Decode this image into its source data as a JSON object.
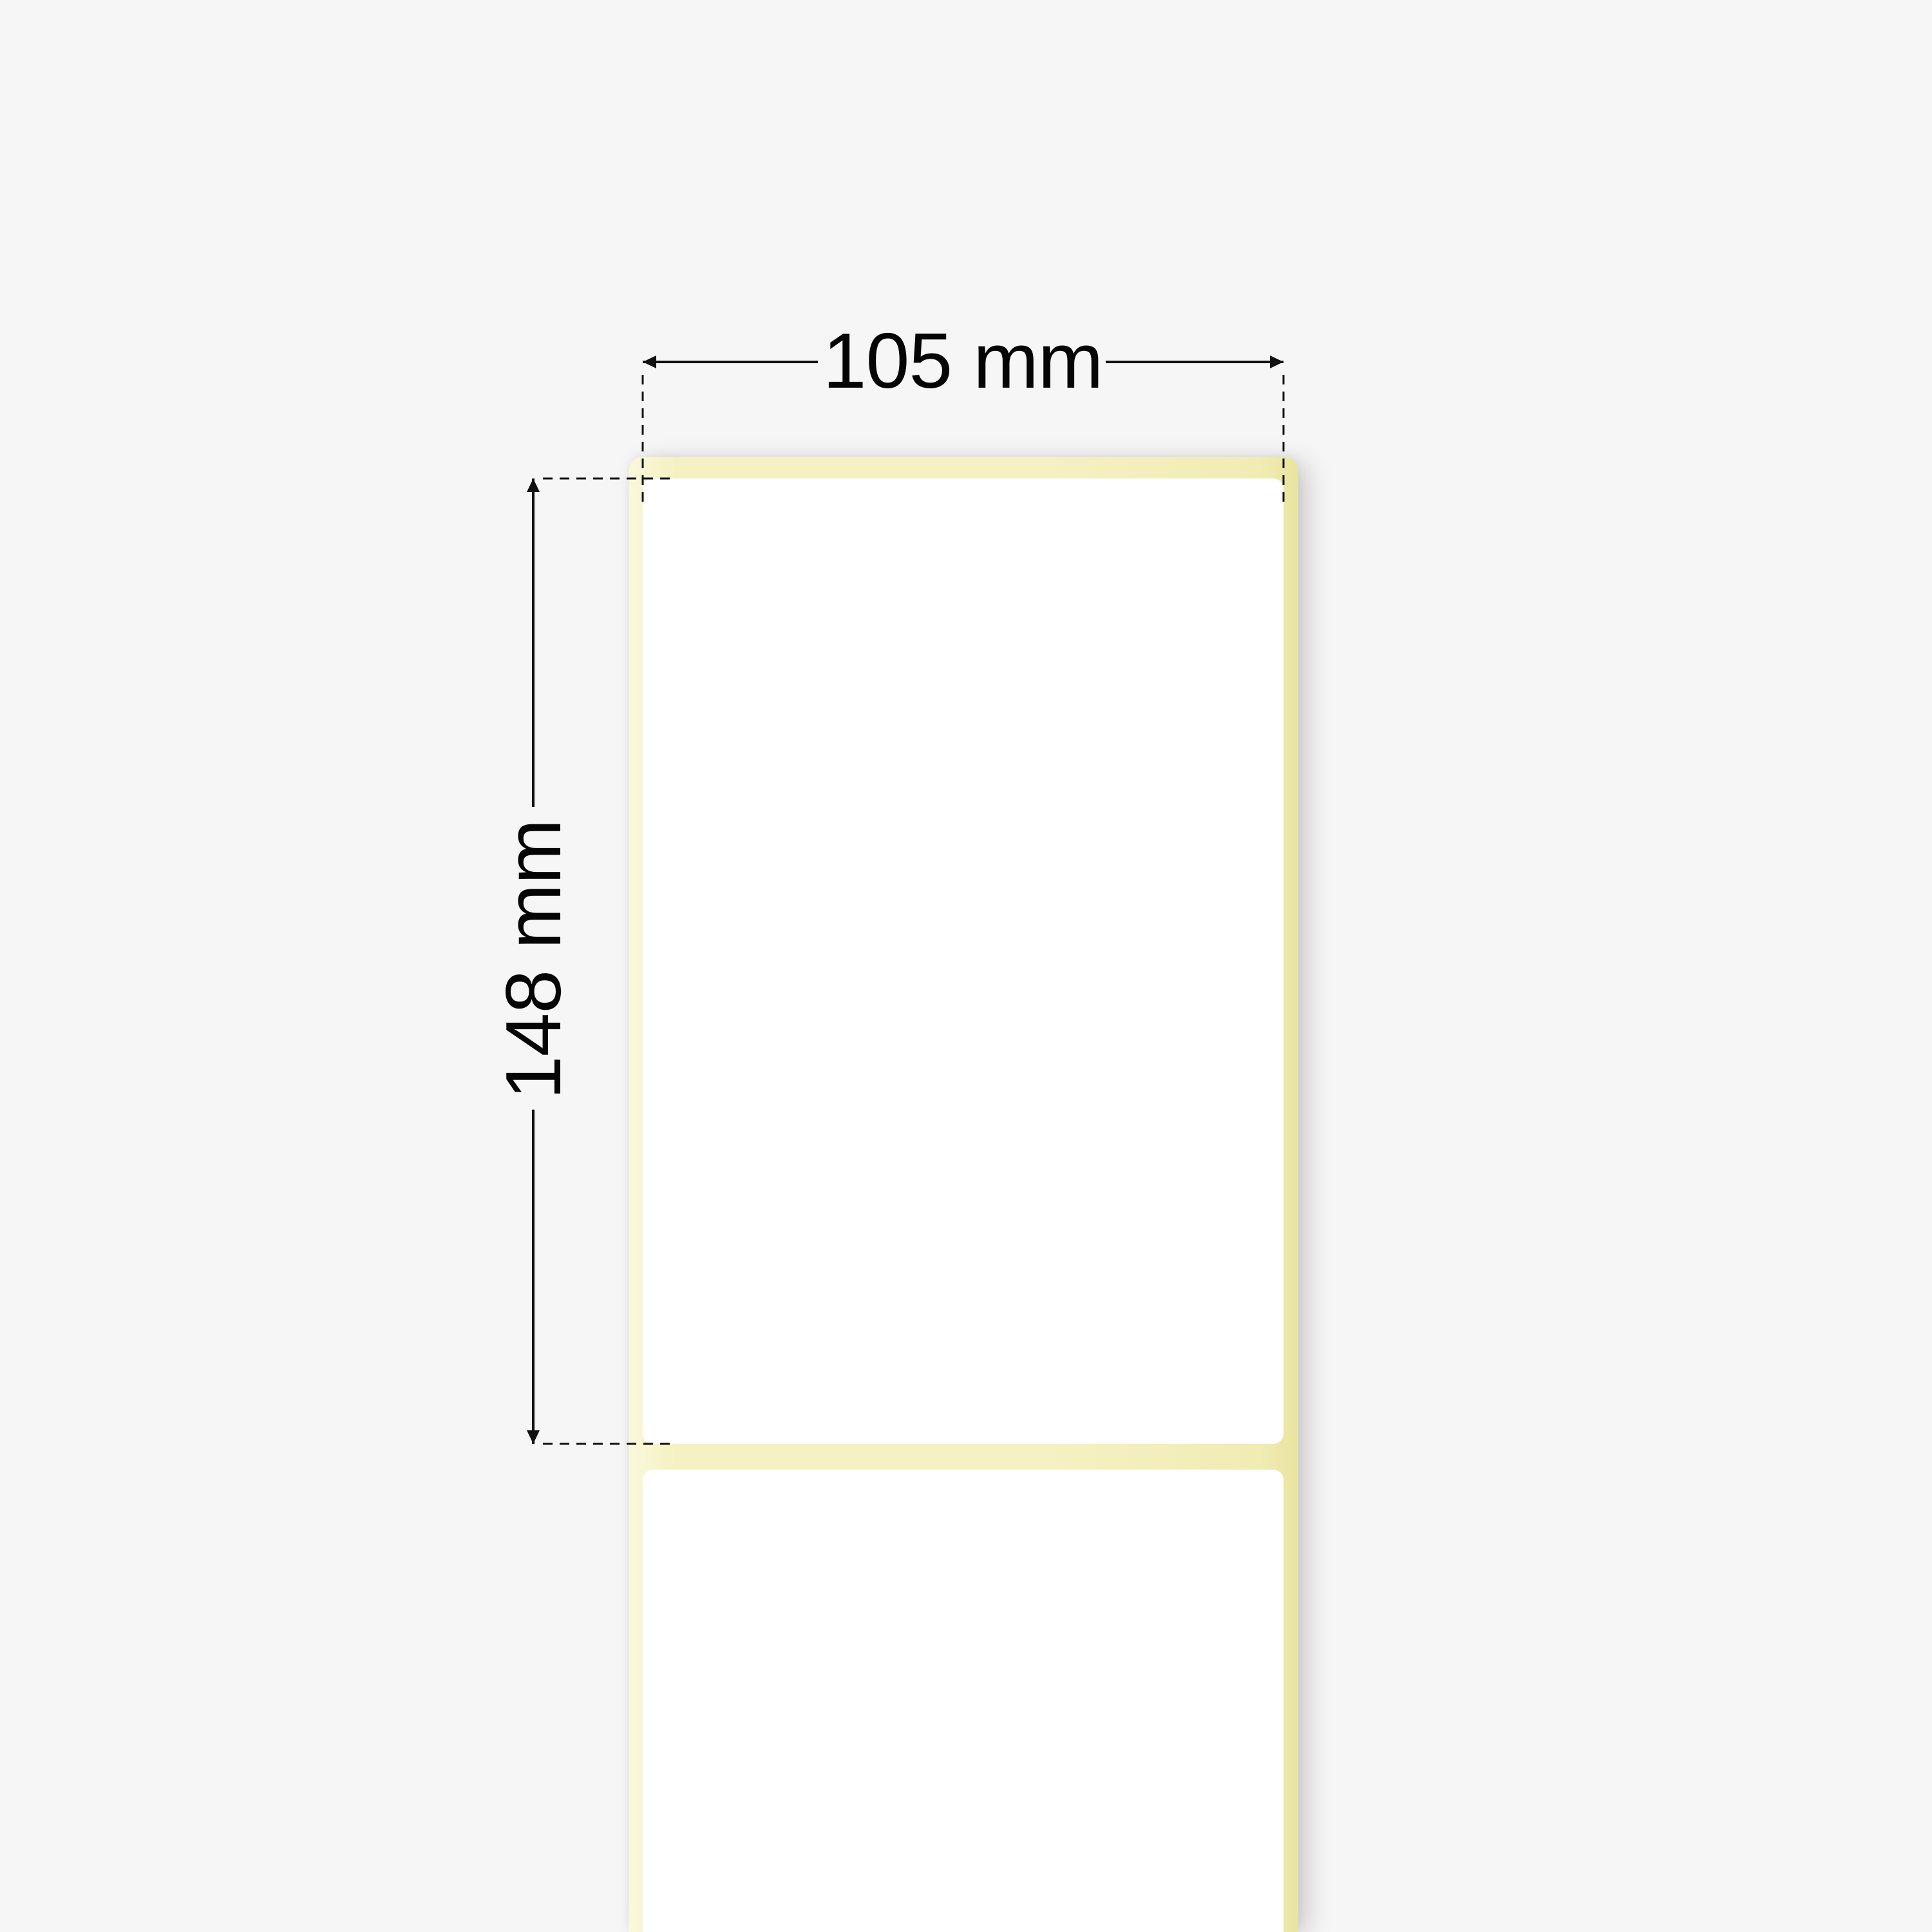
{
  "dimensions": {
    "width_label": "105 mm",
    "height_label": "148 mm"
  },
  "roll": {
    "labels_visible": 2,
    "liner_material": "liner-strip",
    "label_fill": "blank"
  },
  "colors": {
    "background": "#f6f6f6",
    "liner": "#f5f1c2",
    "liner_light": "#faf8dc",
    "liner_dark": "#f1ecb4",
    "liner_edge": "#e9e4a0",
    "label": "#ffffff",
    "line": "#111111",
    "text": "#050505"
  }
}
